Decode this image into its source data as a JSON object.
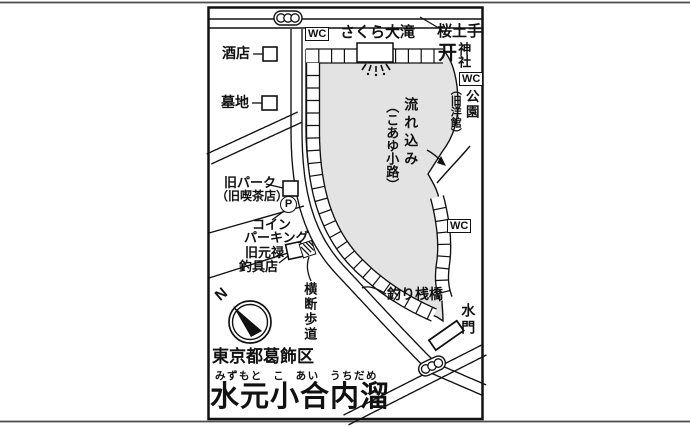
{
  "colors": {
    "background": "#ffffff",
    "line": "#111111",
    "pond_fill": "#e3e3e3",
    "page_rule": "#4a4a4a"
  },
  "map": {
    "region_label": "東京都葛飾区",
    "title": "水元小合内溜",
    "title_furigana": "みずもと こ あい うちだめ",
    "labels": {
      "sakura_dote": "桜土手",
      "sakura_otaki": "さくら大滝",
      "jinja": "神社",
      "park": "公園",
      "park_note": "（旧洋館）",
      "nagarekomi": "流れ込み",
      "nagarekomi_note": "（こあゆ小路）",
      "sakaya": "酒店",
      "bochi": "墓地",
      "kyu_park": "旧パーク",
      "kyu_park_note": "（旧喫茶店）",
      "coin_line1": "コイン",
      "coin_line2": "パーキング",
      "genroku_line1": "旧元禄",
      "genroku_line2": "釣具店",
      "oudan_hodou": "横断歩道",
      "tsuri_sanbashi": "釣り桟橋",
      "suimon": "水門",
      "wc": "WC",
      "parking_p": "P",
      "compass_n": "N"
    },
    "icons": {
      "torii": "开"
    }
  }
}
